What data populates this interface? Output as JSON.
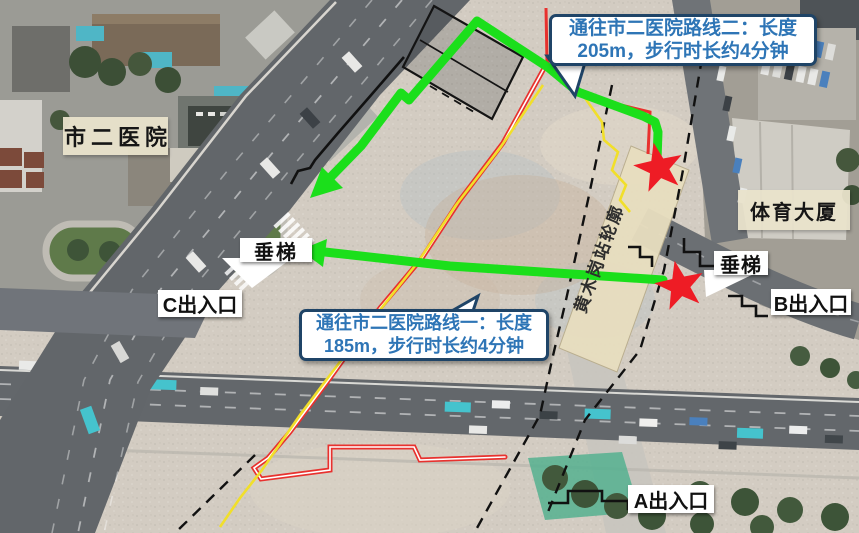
{
  "map": {
    "region_labels": {
      "hospital": "市二医院",
      "sports_building": "体育大厦",
      "station_outline": "黄木岗站轮廓"
    },
    "exits": {
      "a": "A出入口",
      "b": "B出入口",
      "c": "C出入口"
    },
    "elevators": {
      "left": "垂梯",
      "right": "垂梯"
    },
    "callouts": {
      "route2": {
        "line1": "通往市二医院路线二：长度",
        "line2": "205m，步行时长约4分钟"
      },
      "route1": {
        "line1": "通往市二医院路线一：长度",
        "line2": "185m，步行时长约4分钟"
      }
    },
    "routes": [
      {
        "name": "路线一",
        "length_m": 185,
        "walk_time": "约4分钟"
      },
      {
        "name": "路线二",
        "length_m": 205,
        "walk_time": "约4分钟"
      }
    ],
    "icons": {
      "star": "route-endpoint-star",
      "arrow": "route-direction-arrow"
    },
    "colors": {
      "route_green": "#1bdf1b",
      "boundary_red": "#e8312e",
      "boundary_yellow": "#f1df2a",
      "star_red": "#ee1c25",
      "callout_border": "#1f4467",
      "callout_text": "#2e75b6",
      "station_fill": "#e8debf"
    }
  }
}
